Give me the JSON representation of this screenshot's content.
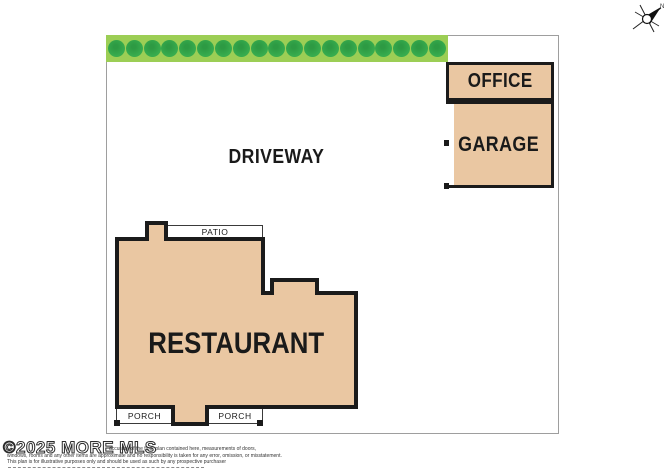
{
  "plan": {
    "driveway_label": "DRIVEWAY",
    "restaurant_label": "RESTAURANT",
    "office_label": "OFFICE",
    "garage_label": "GARAGE",
    "patio_label": "PATIO",
    "porch_left_label": "PORCH",
    "porch_right_label": "PORCH",
    "hedge_tree_count": 19
  },
  "compass": {
    "north_label": "N"
  },
  "footer": {
    "watermark": "©2025 MORE MLS",
    "disclaimer_line1": "accuracy of the floor plan contained here, measurements of doors,",
    "disclaimer_line2": "windows, rooms and any other items are approximate and no responsibility is taken for any error, omission, or misstatement.",
    "disclaimer_line3": "This plan is for illustrative purposes only and should be used as such by any prospective purchaser"
  },
  "colors": {
    "building_fill": "#EAC7A2",
    "outline": "#1B1B1B",
    "hedge_fill": "#9CCE55",
    "tree_fill": "#37AC4E",
    "boundary_line": "#9E9E9E",
    "text": "#1A1A1A"
  }
}
